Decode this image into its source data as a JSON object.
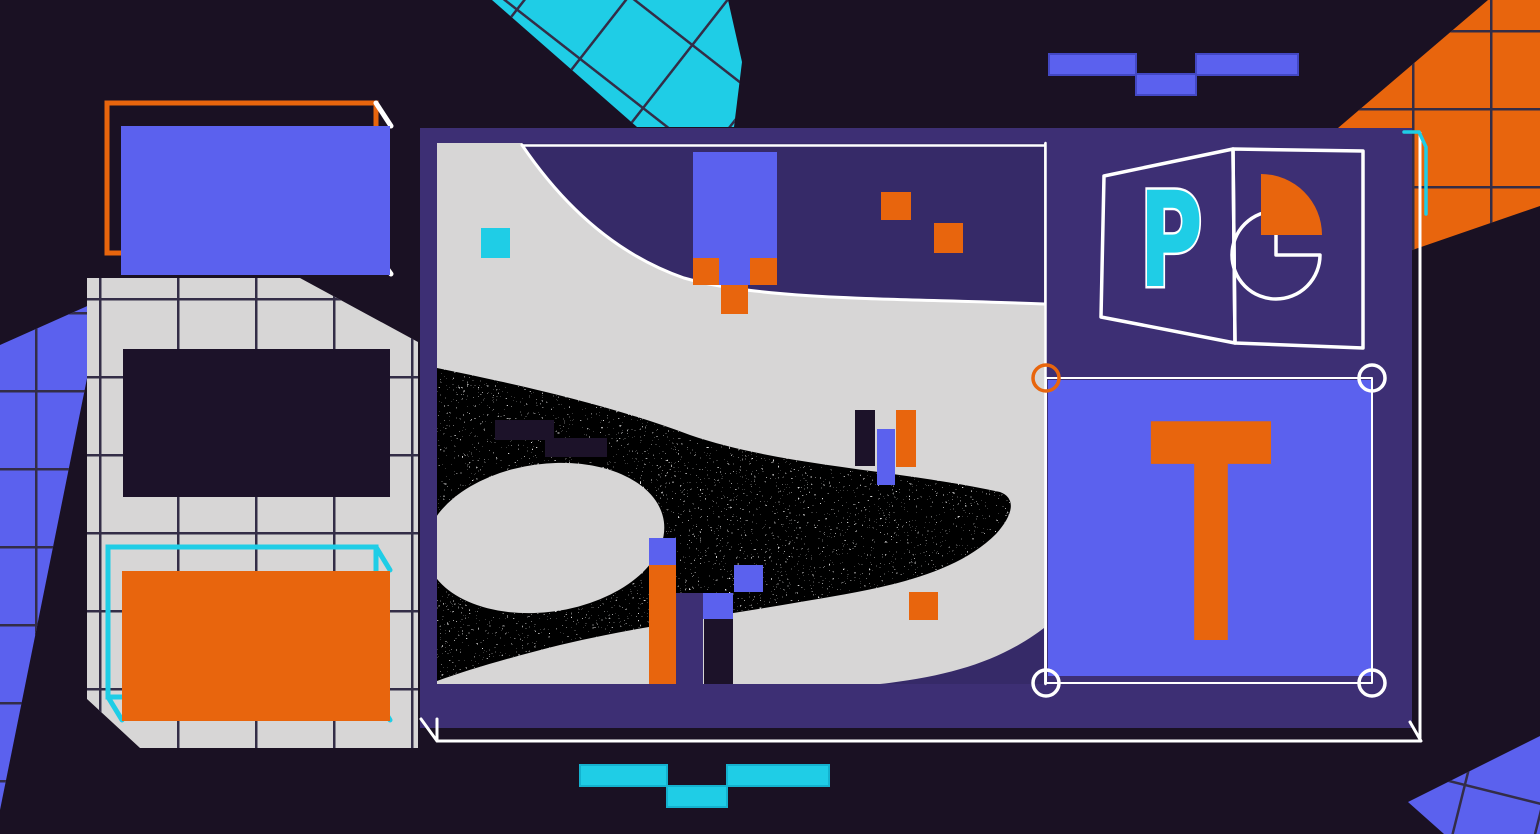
{
  "letters": {
    "powerpoint": "P",
    "text_tool": "T"
  },
  "colors": {
    "bg": "#1a1123",
    "slide": "#3d2f74",
    "swoosh": "#362a68",
    "canvas": "#d7d6d6",
    "periwinkle": "#5b61ee",
    "orange": "#e8650d",
    "teal": "#1fcde6",
    "ink": "#1c1229",
    "grid": "#332d47",
    "white": "#ffffff"
  }
}
